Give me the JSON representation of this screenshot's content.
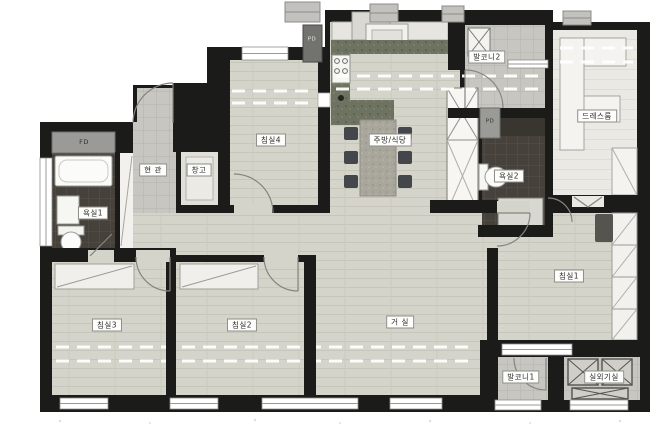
{
  "floorplan": {
    "rooms": [
      {
        "id": "entrance",
        "label": "현 관"
      },
      {
        "id": "storage",
        "label": "창고"
      },
      {
        "id": "bathroom1",
        "label": "욕실1"
      },
      {
        "id": "bedroom4",
        "label": "침실4"
      },
      {
        "id": "kitchen-dining",
        "label": "주방/식당"
      },
      {
        "id": "balcony2",
        "label": "발코니2"
      },
      {
        "id": "dressroom",
        "label": "드레스룸"
      },
      {
        "id": "bathroom2",
        "label": "욕실2"
      },
      {
        "id": "bedroom3",
        "label": "침실3"
      },
      {
        "id": "bedroom2",
        "label": "침실2"
      },
      {
        "id": "living",
        "label": "거 실"
      },
      {
        "id": "bedroom1",
        "label": "침실1"
      },
      {
        "id": "balcony1",
        "label": "발코니1"
      },
      {
        "id": "outdoor-unit",
        "label": "실외기실"
      }
    ],
    "shafts": [
      {
        "id": "fd",
        "label": "FD"
      },
      {
        "id": "pd-top",
        "label": "PD"
      },
      {
        "id": "pd-bath",
        "label": "PD"
      }
    ],
    "colors": {
      "wall": "#1b1b1a",
      "wood_floor": "#d5d4ca",
      "tile_floor": "#c7c6c1",
      "bath_tile": "#46413b",
      "kitchen_counter": "#6d7360",
      "dress_floor": "#eae9e4",
      "furniture_white": "#f4f3f0",
      "shaft_gray": "#9a9a97"
    }
  }
}
